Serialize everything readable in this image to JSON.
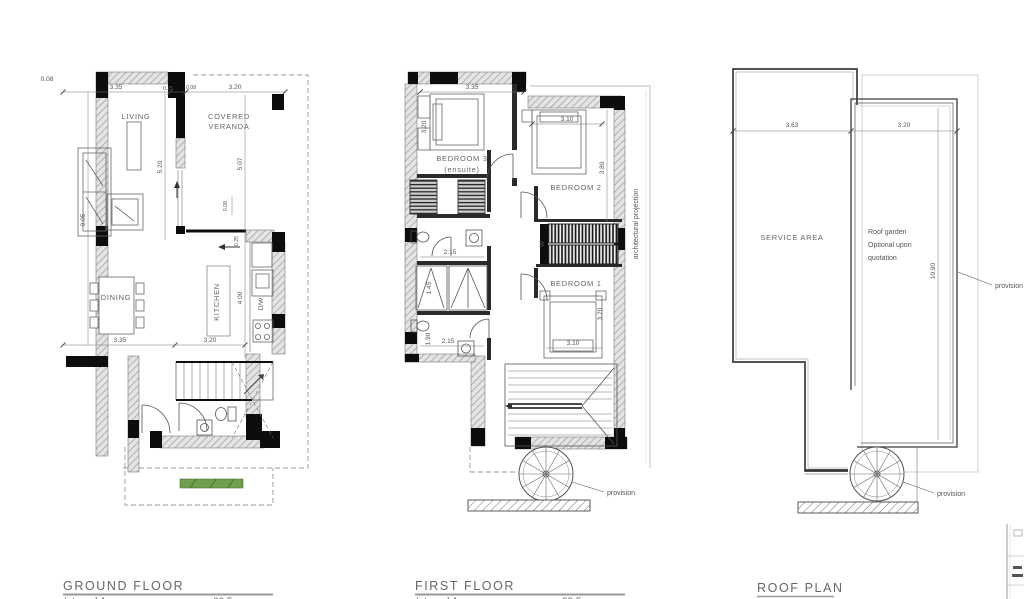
{
  "colors": {
    "wall_fill": "#0d0d0d",
    "line": "#555555",
    "grass_green": "#6fa04e",
    "faint": "#cccccc"
  },
  "ground": {
    "title": "GROUND FLOOR",
    "area_label": "Internal Area",
    "area_value": "66.5",
    "rooms": {
      "living": "LIVING",
      "veranda1": "COVERED",
      "veranda2": "VERANDA",
      "dining": "DINING",
      "kitchen": "KITCHEN",
      "dw": "D/W"
    },
    "dims": {
      "a": "0.08",
      "b": "3.35",
      "c": "0.25",
      "d": "0.08",
      "e": "3.20",
      "f": "9.05",
      "g": "5.20",
      "h": "5.07",
      "i": "0.08",
      "j": "0.25",
      "k": "4.00",
      "l": "3.35",
      "m": "3.20"
    }
  },
  "first": {
    "title": "FIRST FLOOR",
    "area_label": "Internal Area",
    "area_value": "88.5",
    "rooms": {
      "bedroom3a": "BEDROOM 3",
      "bedroom3b": "(ensuite)",
      "bedroom2": "BEDROOM 2",
      "bedroom1": "BEDROOM 1",
      "wardrobe": "W"
    },
    "notes": {
      "projection": "architectural projection",
      "provision": "provision"
    },
    "dims": {
      "a": "3.35",
      "b": "3.20",
      "c": "3.10",
      "d": "3.80",
      "e": "2.15",
      "f": "1.45",
      "g": "1.90",
      "h": "2.15",
      "i": "3.10",
      "j": "3.20"
    }
  },
  "roof": {
    "title": "ROOF PLAN",
    "rooms": {
      "service": "SERVICE AREA",
      "garden1": "Roof garden",
      "garden2": "Optional upon",
      "garden3": "quotation"
    },
    "notes": {
      "provision": "provision"
    },
    "dims": {
      "a": "3.63",
      "b": "3.20",
      "c": "10.90"
    }
  }
}
